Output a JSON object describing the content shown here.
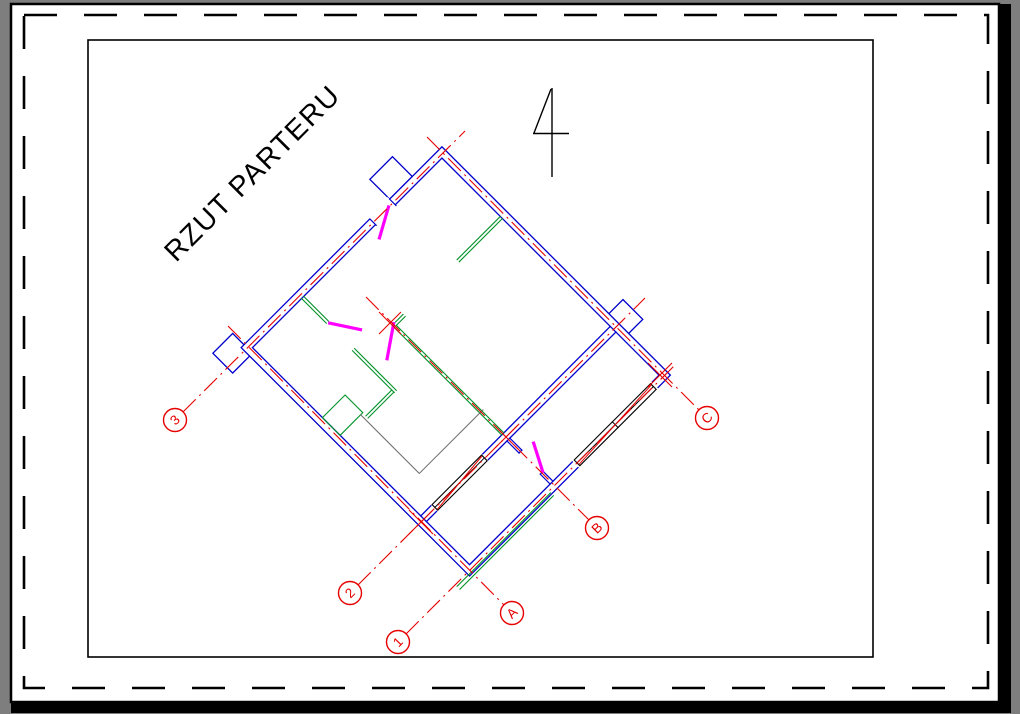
{
  "drawing": {
    "title": "RZUT PARTERU",
    "axis_bubbles": [
      {
        "label": "3"
      },
      {
        "label": "2"
      },
      {
        "label": "1"
      },
      {
        "label": "A"
      },
      {
        "label": "B"
      },
      {
        "label": "C"
      }
    ],
    "icons": {
      "north_arrow": "north-arrow"
    }
  },
  "colors": {
    "canvas_background": "#7e7e7e",
    "paper": "#ffffff",
    "frame": "#000000",
    "walls": "#0000cc",
    "axes_and_bubbles": "#e60000",
    "partitions": "#009127",
    "doors": "#ff00ff",
    "stairs": "#6a6a6a"
  }
}
